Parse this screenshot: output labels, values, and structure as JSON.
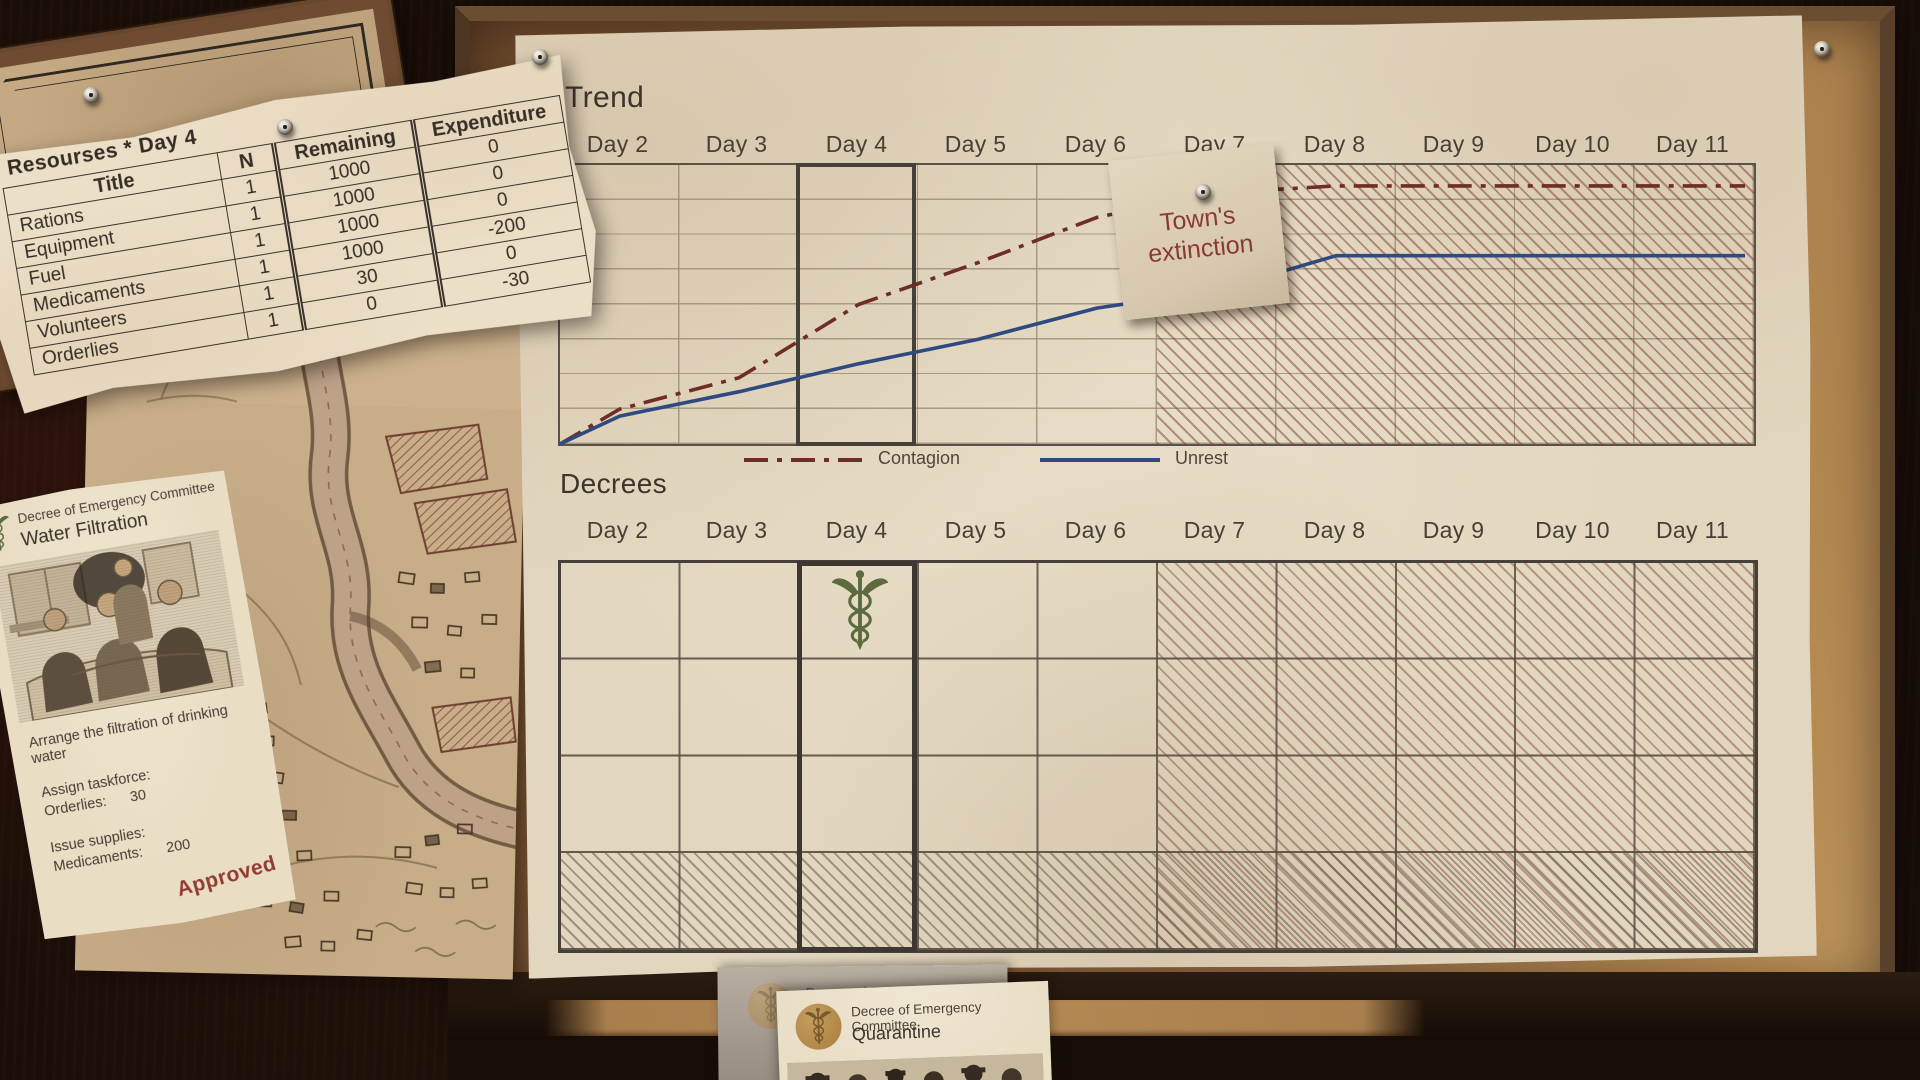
{
  "days": [
    "Day 2",
    "Day 3",
    "Day 4",
    "Day 5",
    "Day 6",
    "Day 7",
    "Day 8",
    "Day 9",
    "Day 10",
    "Day 11"
  ],
  "trend": {
    "title": "Trend"
  },
  "legend": {
    "contagion_label": "Contagion",
    "unrest_label": "Unrest"
  },
  "note": {
    "line1": "Town's",
    "line2": "extinction"
  },
  "decrees": {
    "title": "Decrees",
    "current_day": "Day 4",
    "rows": 4,
    "placed": [
      {
        "day": "Day 4",
        "row": 1,
        "icon": "caduceus-icon",
        "decree": "Water Filtration"
      }
    ],
    "locked_days": [
      "Day 7",
      "Day 8",
      "Day 9",
      "Day 10",
      "Day 11"
    ]
  },
  "resources_table": {
    "title": "Resourses *  Day 4",
    "columns": [
      "Title",
      "N",
      "Remaining",
      "Expenditure"
    ],
    "rows": [
      {
        "title": "Rations",
        "n": "1",
        "remaining": "1000",
        "expenditure": "0"
      },
      {
        "title": "Equipment",
        "n": "1",
        "remaining": "1000",
        "expenditure": "0"
      },
      {
        "title": "Fuel",
        "n": "1",
        "remaining": "1000",
        "expenditure": "0"
      },
      {
        "title": "Medicaments",
        "n": "1",
        "remaining": "1000",
        "expenditure": "-200"
      },
      {
        "title": "Volunteers",
        "n": "1",
        "remaining": "30",
        "expenditure": "0"
      },
      {
        "title": "Orderlies",
        "n": "1",
        "remaining": "0",
        "expenditure": "-30"
      }
    ]
  },
  "water_filtration_card": {
    "committee": "Decree of Emergency Committee",
    "title": "Water Filtration",
    "description": "Arrange the filtration of drinking water",
    "taskforce_label": "Assign taskforce:",
    "taskforce_row": {
      "name": "Orderlies:",
      "value": "30"
    },
    "supplies_label": "Issue supplies:",
    "supplies_row": {
      "name": "Medicaments:",
      "value": "200"
    },
    "stamp": "Approved"
  },
  "quarantine_card": {
    "committee": "Decree of Emergency Committee",
    "title": "Quarantine"
  },
  "back_card": {
    "committee": "Decree of Emergency Committee"
  },
  "colors": {
    "contagion": "#6e2d26",
    "unrest": "#2e4a80",
    "hatch_red": "#76382c",
    "ink": "#3b352d",
    "approved_stamp": "#8a2f24",
    "note_text": "#8a3a30",
    "seal_tan": "#b08948",
    "decree_icon_green": "#5c6b3e"
  },
  "chart_data": {
    "type": "line",
    "title": "Trend",
    "categories": [
      "Day 2",
      "Day 3",
      "Day 4",
      "Day 5",
      "Day 6",
      "Day 7",
      "Day 8",
      "Day 9",
      "Day 10",
      "Day 11"
    ],
    "ylim": [
      0,
      8
    ],
    "grid_rows": 8,
    "legend_position": "bottom",
    "series": [
      {
        "name": "Contagion",
        "color": "#6e2d26",
        "style": "dash-dot",
        "values": [
          1.0,
          1.9,
          4.0,
          5.2,
          6.5,
          7.2,
          7.4,
          7.4,
          7.4,
          7.4
        ]
      },
      {
        "name": "Unrest",
        "color": "#2e4a80",
        "style": "solid",
        "values": [
          0.8,
          1.5,
          2.3,
          3.0,
          3.9,
          4.4,
          5.4,
          5.4,
          5.4,
          5.4
        ]
      }
    ],
    "annotations": [
      {
        "text": "Town's extinction",
        "position": "pinned note near Day 7, top of chart"
      }
    ],
    "highlighted_day": "Day 4",
    "hatched_days": [
      "Day 7",
      "Day 8",
      "Day 9",
      "Day 10",
      "Day 11"
    ]
  }
}
